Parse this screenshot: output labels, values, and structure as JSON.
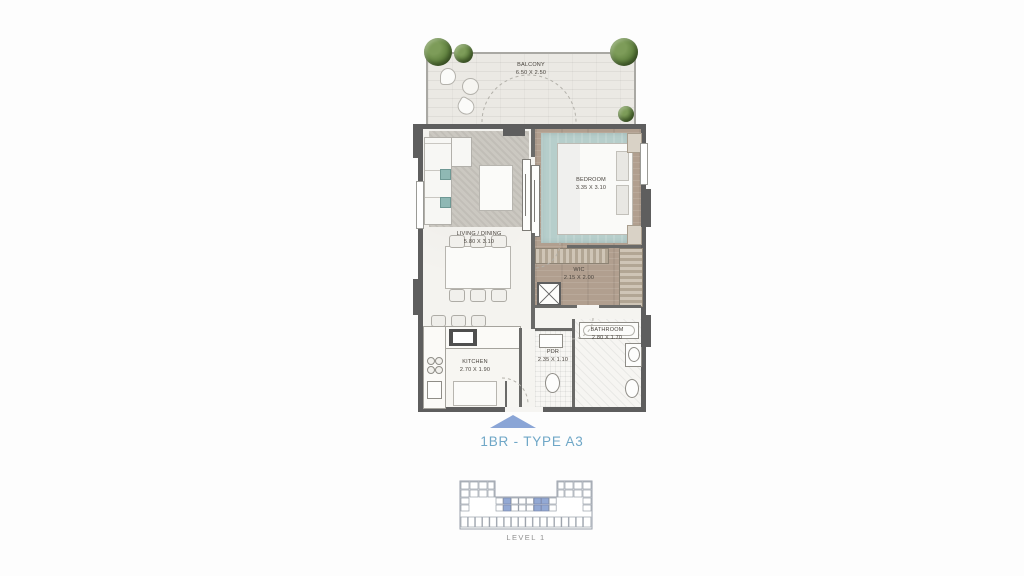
{
  "title": "1BR - TYPE A3",
  "key_plan": {
    "label": "LEVEL 1"
  },
  "rooms": {
    "balcony": {
      "name": "BALCONY",
      "dims": "6.50 X 2.50"
    },
    "living": {
      "name": "LIVING / DINING",
      "dims": "5.80 X 3.10"
    },
    "bedroom": {
      "name": "BEDROOM",
      "dims": "3.35 X 3.10"
    },
    "wic": {
      "name": "WIC",
      "dims": "2.15 X 2.00"
    },
    "kitchen": {
      "name": "KITCHEN",
      "dims": "2.70 X 1.90"
    },
    "pdr": {
      "name": "PDR",
      "dims": "2.35 X 1.10"
    },
    "bathroom": {
      "name": "BATHROOM",
      "dims": "2.80 X 1.70"
    }
  },
  "icons": {
    "entry_arrow": "triangle-up",
    "plant": "greenery-circle",
    "shaft": "x-box"
  },
  "colors": {
    "pageBg": "#fdfdfd",
    "titleBlue": "#6fa7c7",
    "entryArrow": "#8aa5d6",
    "keyHighlight": "#93a9d4",
    "wallDark": "#5e5e5e",
    "woodFloor": "#b19f8f",
    "rugTeal": "#b6cecb",
    "balconyTile": "#ebe9e4",
    "levelGray": "#8f8f8f"
  }
}
